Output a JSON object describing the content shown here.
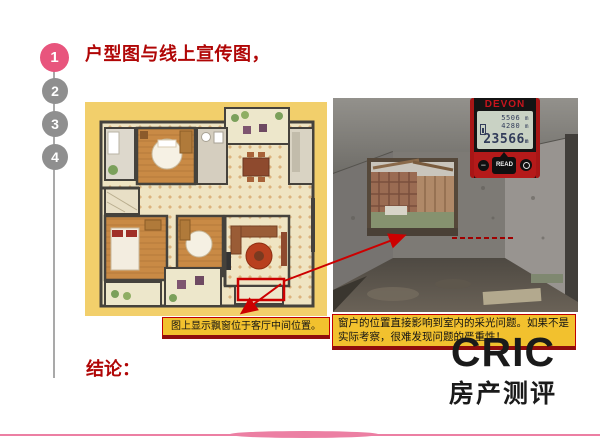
{
  "slide": {
    "title": "户型图与线上宣传图，",
    "conclusion": "结论：",
    "steps": [
      {
        "label": "1"
      },
      {
        "label": "2"
      },
      {
        "label": "3"
      },
      {
        "label": "4"
      }
    ],
    "caption_left": "图上显示飘窗位于客厅中间位置。",
    "caption_right": "窗户的位置直接影响到室内的采光问题。如果不是实际考察，很难发现问题的严重性！",
    "logo": {
      "brand": "CRIC",
      "subtitle": "房产测评"
    },
    "device": {
      "brand": "DEVON",
      "display": {
        "reading1": "5506",
        "reading2": "4280",
        "main": "23566",
        "unit": "m"
      },
      "keys": {
        "minus": "−",
        "read": "READ"
      }
    },
    "colors": {
      "title_red": "#b00606",
      "annotation_red": "#cc0000",
      "caption_bg": "#f2c12e",
      "caption_border": "#c00000",
      "step_active": "#e8557d",
      "step_inactive": "#8f8f8f",
      "wave_pink": "#ec7fa3",
      "plan_bg": "#f2cf6b"
    }
  }
}
